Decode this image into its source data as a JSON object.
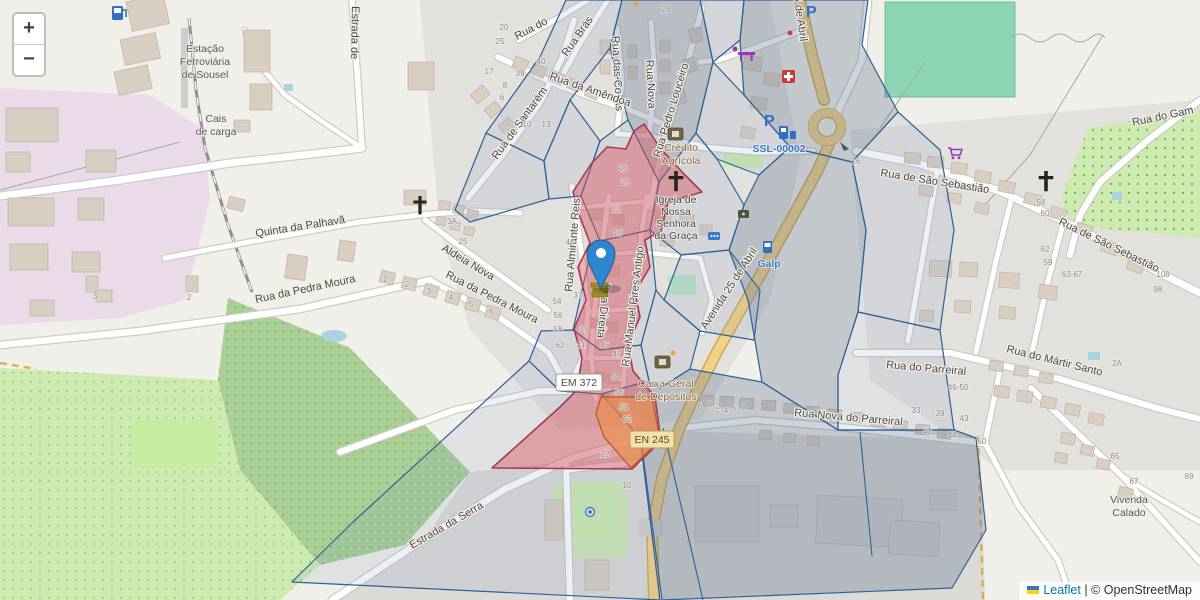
{
  "controls": {
    "zoom_in_label": "+",
    "zoom_out_label": "−"
  },
  "attribution": {
    "leaflet_link": "Leaflet",
    "separator": "|",
    "osm_credit": "© OpenStreetMap"
  },
  "accent_colors": {
    "highlight_red": "#db5860",
    "highlight_orange": "#ee8c46",
    "overlay_blue": "#2e6195",
    "marker_blue": "#2E86CF",
    "main_road_yellow": "#f3d186",
    "poi_link_blue": "#3c7ad1"
  },
  "streets": {
    "estrada_de": "Estrada de",
    "rua_do": "Rua do",
    "rua_bras": "Rua Brás",
    "rua_das_covas": "Rua das Covas",
    "rua_nova": "Rua Nova",
    "rua_pedro_louceiro": "Rua Pedro Louceiro",
    "rua_da_amendoa": "Rua da Amêndoa",
    "rua_de_santarem": "Rua de Santarém",
    "rua_almirante_reis": "Rua Almirante Reis",
    "rua_direita": "Rua Direita",
    "rua_manuel_pires_antigo": "Rua Manuel Pires Antigo",
    "avenida_25_de_abril": "Avenida 25 de Abril",
    "rua_de_sao_sebastiao": "Rua de São Sebastião",
    "rua_do_gam": "Rua do Gam",
    "rua_do_martir_santo": "Rua do Mártir Santo",
    "rua_do_parreiral": "Rua do Parreiral",
    "rua_nova_do_parreiral": "Rua Nova do Parreiral",
    "quinta_da_palhava": "Quinta da Palhavã",
    "rua_da_pedra_moura": "Rua da Pedra Moura",
    "aldeia_nova": "Aldeia Nova",
    "estrada_da_serra": "Estrada da Serra"
  },
  "shields": {
    "em372": "EM 372",
    "en245": "EN 245"
  },
  "pois": {
    "station": {
      "lines": [
        "Estação",
        "Ferroviária",
        "de Sousel"
      ]
    },
    "cargo": {
      "lines": [
        "Cais",
        "de carga"
      ]
    },
    "credito_agricola": {
      "lines": [
        "Crédito",
        "Agrícola"
      ]
    },
    "igreja": {
      "lines": [
        "Igreja de",
        "Nossa",
        "Senhora",
        "da Graça"
      ]
    },
    "caixa_geral": {
      "lines": [
        "Caixa Geral",
        "de Depósitos"
      ]
    },
    "galp": "Galp",
    "ssl_code": "SSL-00002",
    "vivenda": {
      "lines": [
        "Vivenda",
        "Calado"
      ]
    }
  },
  "housenumbers": [
    "20",
    "25",
    "28",
    "17",
    "40",
    "39",
    "8",
    "6",
    "10",
    "13",
    "16",
    "37",
    "39",
    "41",
    "54",
    "56",
    "58",
    "62",
    "46",
    "47",
    "54",
    "56",
    "58",
    "62",
    "12",
    "10",
    "6",
    "8",
    "2",
    "4",
    "6",
    "8",
    "33",
    "39",
    "43",
    "40",
    "44",
    "50",
    "46-50",
    "58",
    "60",
    "62",
    "59",
    "63-67",
    "108",
    "98",
    "2A",
    "65",
    "67",
    "69",
    "3A",
    "25",
    "1",
    "2",
    "3",
    "4",
    "5",
    "6",
    "3",
    "2",
    "16",
    "18",
    "22",
    "15",
    "44"
  ]
}
